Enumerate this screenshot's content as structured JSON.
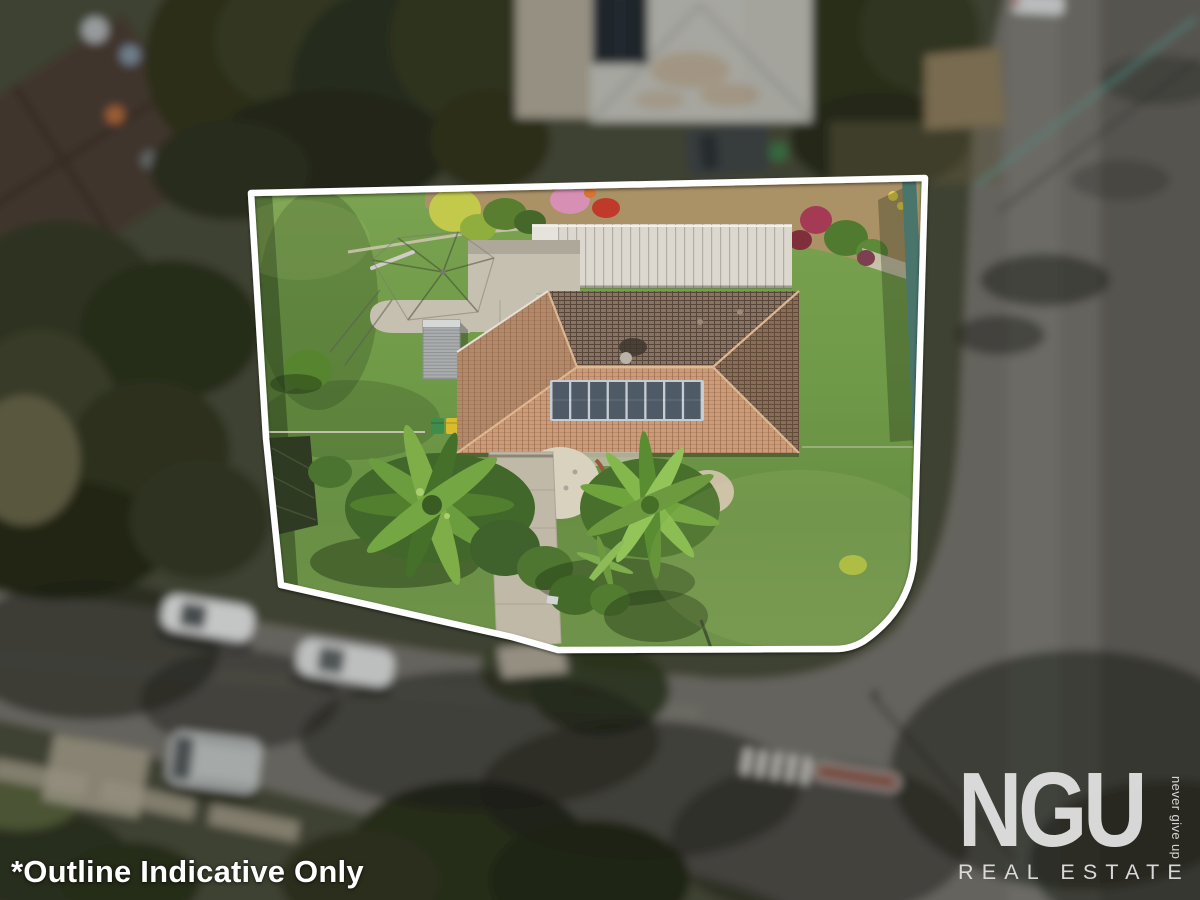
{
  "photo": {
    "disclaimer": "*Outline Indicative Only",
    "watermark": {
      "brand": "NGU",
      "subtitle": "REAL ESTATE",
      "tagline": "never give up"
    }
  },
  "colors": {
    "outline": "#ffffff",
    "watermark_text": "#e5e5e5",
    "lawn": "#6f9a48",
    "roof_tiles": "#c89a74",
    "road": "#787670",
    "solar_panel": "#4e5a66"
  }
}
